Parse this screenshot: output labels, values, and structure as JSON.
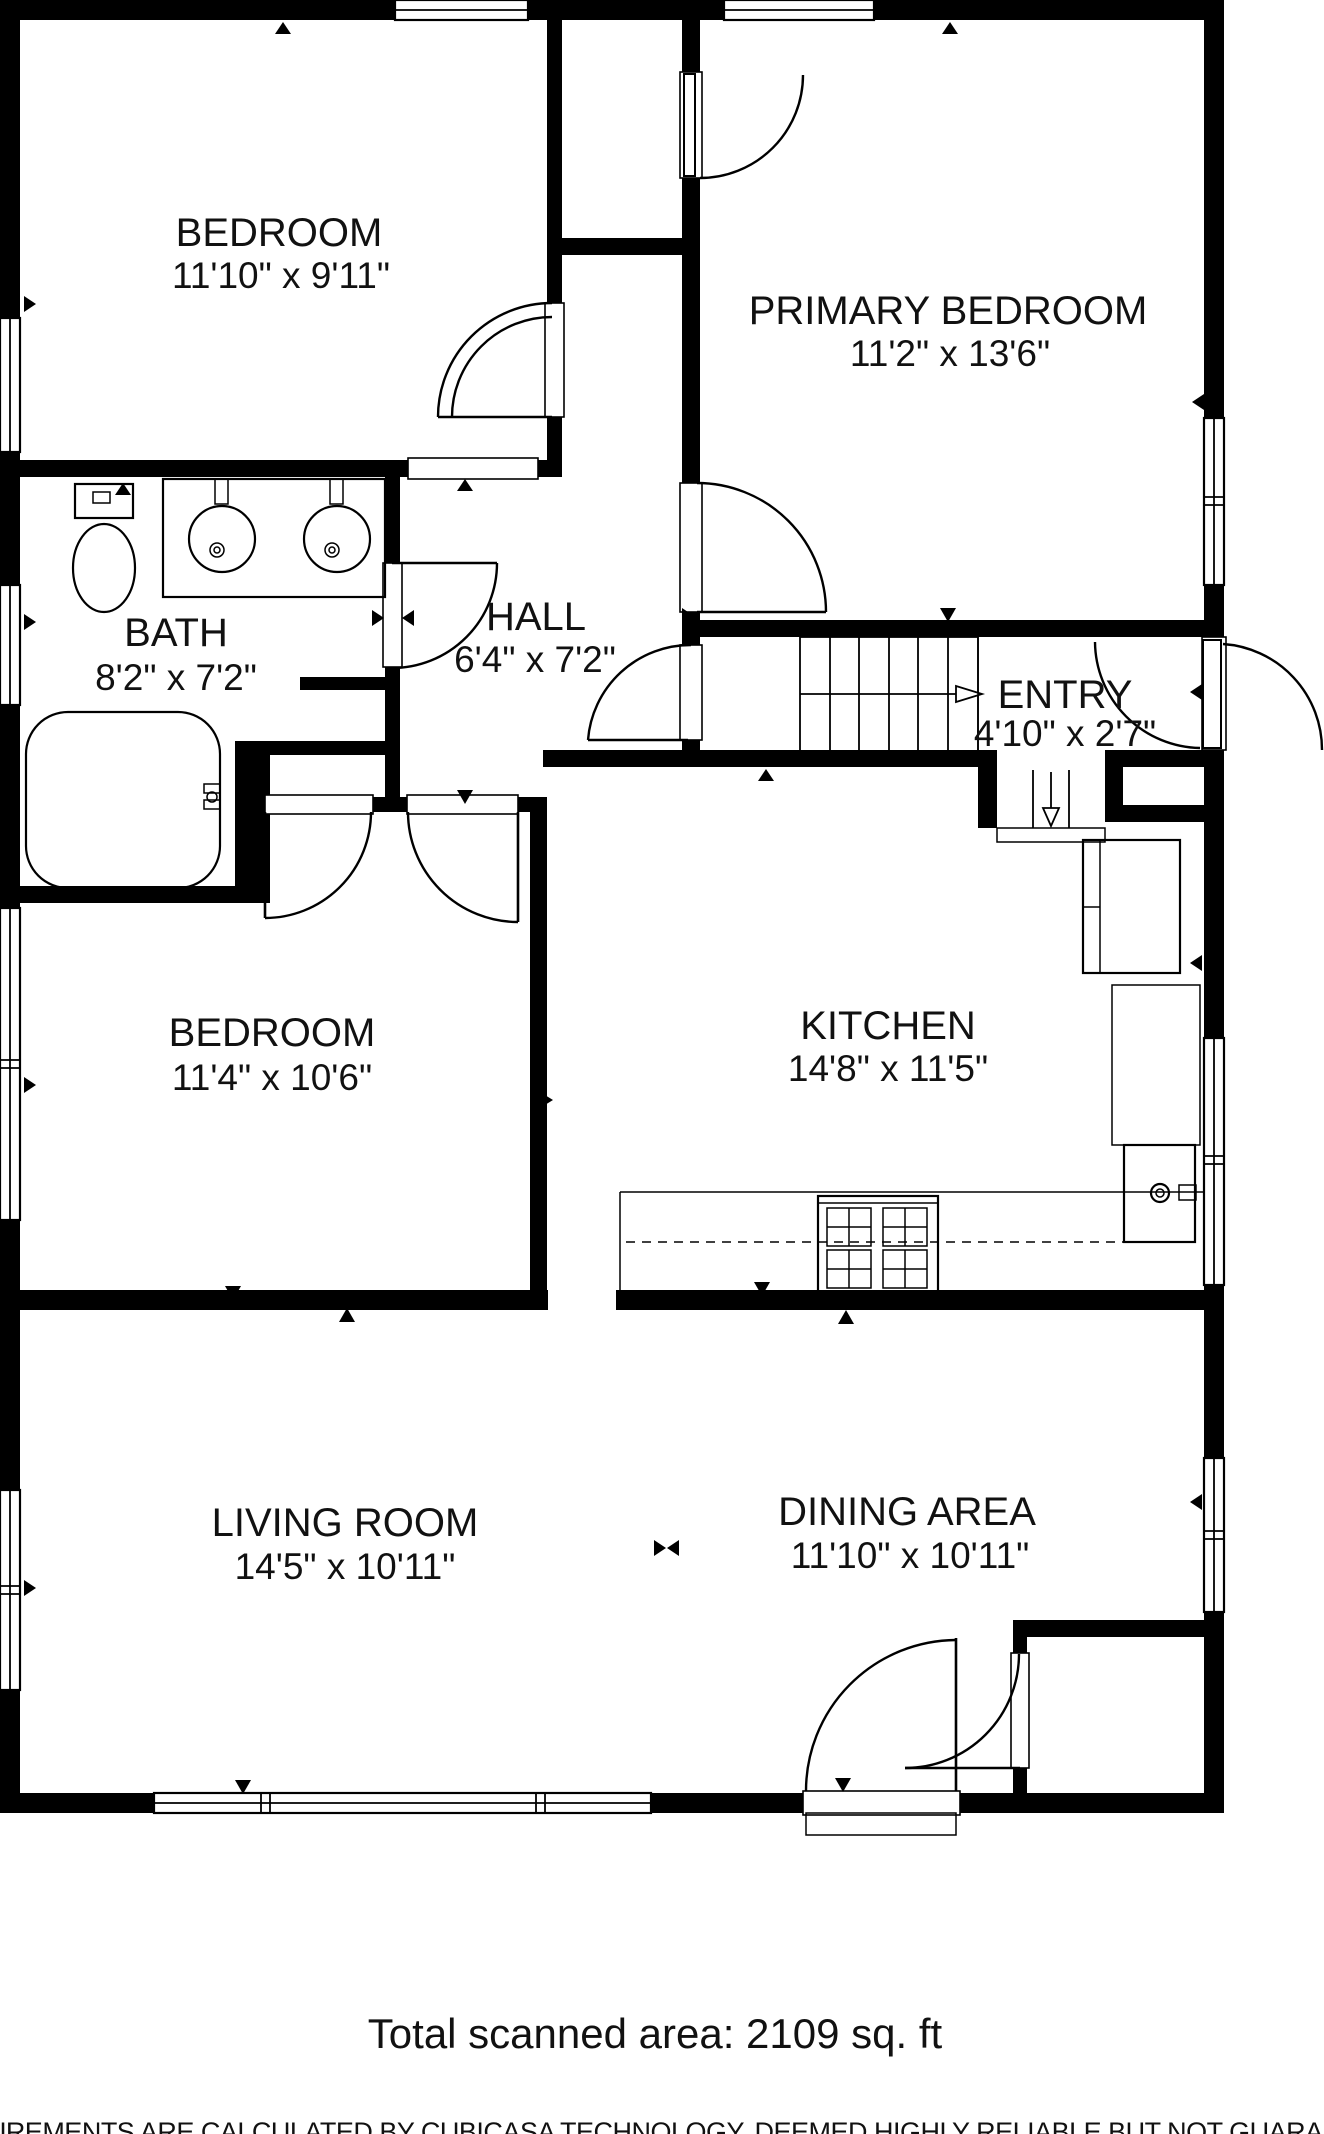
{
  "floorplan": {
    "source_brand": "CubiCasa",
    "colors": {
      "walls": "#000000",
      "background": "#ffffff",
      "text": "#111111"
    },
    "rooms": [
      {
        "id": "bedroom-top",
        "name": "BEDROOM",
        "dims": "11'10\" x 9'11\""
      },
      {
        "id": "primary-bedroom",
        "name": "PRIMARY BEDROOM",
        "dims": "11'2\" x 13'6\""
      },
      {
        "id": "bath",
        "name": "BATH",
        "dims": "8'2\" x 7'2\""
      },
      {
        "id": "hall",
        "name": "HALL",
        "dims": "6'4\" x 7'2\""
      },
      {
        "id": "entry",
        "name": "ENTRY",
        "dims": "4'10\" x 2'7\""
      },
      {
        "id": "bedroom-middle",
        "name": "BEDROOM",
        "dims": "11'4\" x 10'6\""
      },
      {
        "id": "kitchen",
        "name": "KITCHEN",
        "dims": "14'8\" x 11'5\""
      },
      {
        "id": "living-room",
        "name": "LIVING ROOM",
        "dims": "14'5\" x 10'11\""
      },
      {
        "id": "dining-area",
        "name": "DINING AREA",
        "dims": "11'10\" x 10'11\""
      }
    ],
    "footer": {
      "total_area": "Total scanned area: 2109 sq. ft",
      "disclaimer": "MEASUREMENTS ARE CALCULATED BY CUBICASA TECHNOLOGY. DEEMED HIGHLY RELIABLE BUT NOT GUARANTEED"
    },
    "fixtures": [
      "toilet",
      "double-sink-vanity",
      "bathtub",
      "refrigerator",
      "kitchen-sink",
      "stove",
      "stairs-up",
      "stairs-down",
      "basement-steps"
    ]
  }
}
